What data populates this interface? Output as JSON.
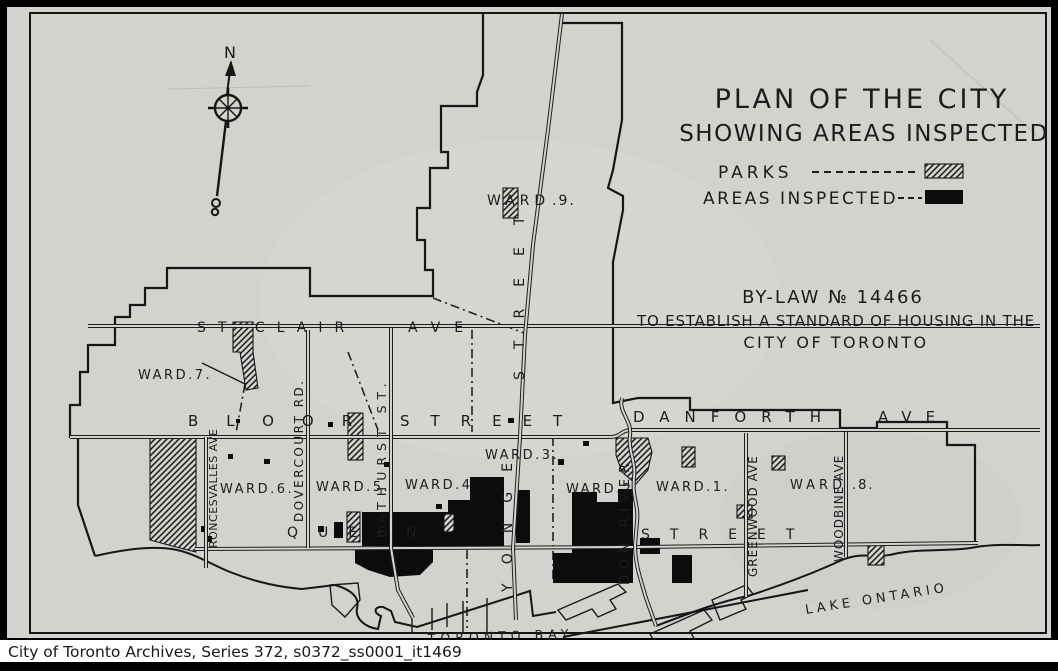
{
  "colors": {
    "paper": "#d3d2cf",
    "ink": "#1b1b1b",
    "frame": "#000000",
    "caption_bg": "#ffffff",
    "caption_text": "#1a1a1a"
  },
  "caption": "City of Toronto Archives, Series 372,  s0372_ss0001_it1469",
  "title_block": {
    "line1": "PLAN OF THE CITY",
    "line2": "SHOWING AREAS INSPECTED"
  },
  "legend": {
    "parks_label": "PARKS",
    "areas_label": "AREAS  INSPECTED"
  },
  "bylaw": {
    "line1": "BY-LAW  № 14466",
    "line2": "TO ESTABLISH A STANDARD OF HOUSING IN THE",
    "line3": "CITY OF TORONTO"
  },
  "compass": {
    "north": "N"
  },
  "wards": {
    "w9a": "WARD",
    "w9b": ".9.",
    "w7": "WARD.7.",
    "w6": "WARD.6.",
    "w5": "WARD.5.",
    "w4": "WARD.4",
    "w3": "WARD.3.",
    "w2": "WARD.2",
    "w1": "WARD.1.",
    "w8a": "WARD",
    "w8b": ".8."
  },
  "streets": {
    "st_clair": "ST CLAIR",
    "st_clair_ave": "AVE",
    "bloor": "BLOOR",
    "bloor_street": "STREET",
    "danforth": "DANFORTH",
    "danforth_ave": "AVE",
    "queen": "QUEEN",
    "queen_street": "STREET",
    "yonge": "YONGE",
    "yonge_street": "STREET",
    "bathurst": "BATHURST ST.",
    "dovercourt": "DOVERCOURT RD.",
    "roncesvalles": "RONCESVALLES AVE",
    "greenwood": "GREENWOOD AVE",
    "woodbine": "WOODBINE AVE",
    "don_river": "DON RIVER"
  },
  "water": {
    "bay": "TORONTO BAY",
    "lake": "LAKE ONTARIO"
  }
}
